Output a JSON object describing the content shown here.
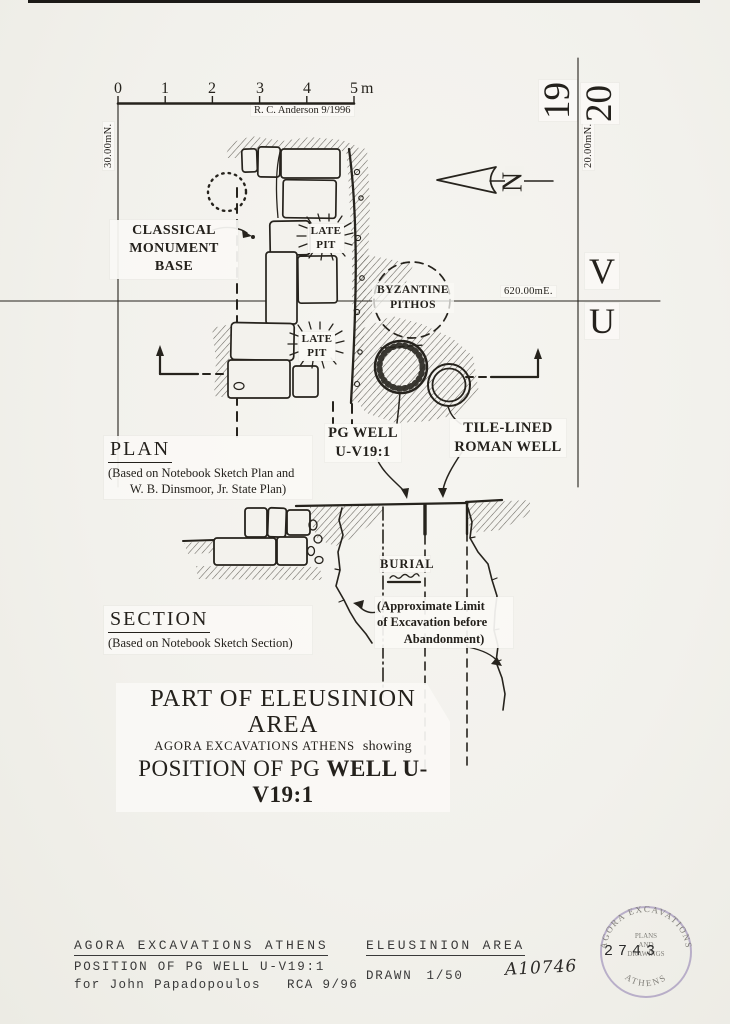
{
  "scale_bar": {
    "ticks": [
      "0",
      "1",
      "2",
      "3",
      "4",
      "5"
    ],
    "unit": "m",
    "credit": "R. C. Anderson  9/1996"
  },
  "grid": {
    "col_19": "19",
    "col_20": "20",
    "row_v": "V",
    "row_u": "U",
    "n30": "30.00mN.",
    "n20": "20.00mN.",
    "e620": "620.00mE."
  },
  "north": {
    "label": "N"
  },
  "plan": {
    "heading": "PLAN",
    "note_line1": "(Based on Notebook Sketch Plan and",
    "note_line2": "W. B. Dinsmoor, Jr. State Plan)",
    "classical_line1": "CLASSICAL",
    "classical_line2": "MONUMENT BASE",
    "late_pit_line1": "LATE",
    "late_pit_line2": "PIT",
    "pithos_line1": "BYZANTINE",
    "pithos_line2": "PITHOS",
    "pg_well_line1": "PG WELL",
    "pg_well_line2": "U-V19:1",
    "roman_well_line1": "TILE-LINED",
    "roman_well_line2": "ROMAN WELL"
  },
  "section": {
    "heading": "SECTION",
    "note": "(Based on Notebook Sketch Section)",
    "burial": "BURIAL",
    "limit_line1": "(Approximate Limit",
    "limit_line2": "of Excavation before",
    "limit_line3": "Abandonment)"
  },
  "title_block": {
    "line1": "PART OF ELEUSINION AREA",
    "line2a": "AGORA EXCAVATIONS ATHENS",
    "line2b": "showing",
    "line3a": "POSITION OF PG ",
    "line3b": "WELL U-V19:1"
  },
  "footer": {
    "left_line1": "AGORA EXCAVATIONS ATHENS",
    "left_line2": "POSITION OF PG WELL U-V19:1",
    "left_line3a": "for John Papadopoulos",
    "left_line3b": "RCA 9/96",
    "right_line1": "ELEUSINION AREA",
    "right_line2a": "DRAWN",
    "right_line2b": "1/50",
    "catalog_number": "A10746",
    "stamp_number": "2743"
  },
  "stamp": {
    "arc_top": "AGORA EXCAVATIONS",
    "arc_bottom": "ATHENS",
    "center_line1": "PLANS",
    "center_line2": "AND",
    "center_line3": "DRAWINGS"
  },
  "colors": {
    "ink": "#26231d",
    "paper": "#f2f1ec",
    "label_bg": "#faf9f5",
    "stamp_purple": "#8d7cb0"
  }
}
